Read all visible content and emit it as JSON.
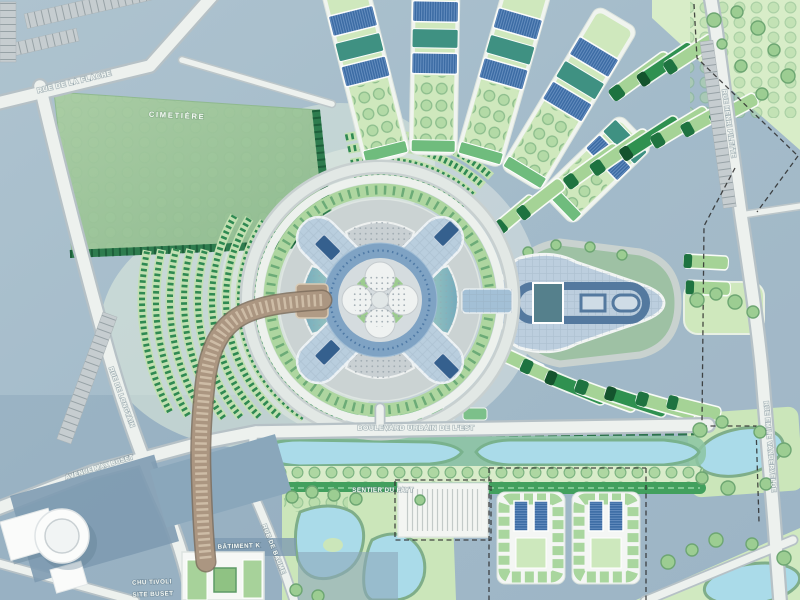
{
  "map": {
    "labels": {
      "cimetiere": "CIMETIÈRE",
      "rue_de_la_flache": "RUE DE LA FLACHE",
      "rue_de_longtain": "RUE DE LONGTAIN",
      "avenue_max_buset": "AVENUE MAX BUSET",
      "rue_henri_pilette": "RUE HENRI PILETTE",
      "rue_emile_vandervelde": "RUE EMILE VANDERVELDE",
      "boulevard_urbain": "BOULEVARD URBAIN DE L'EST",
      "sentier_du_fayt": "SENTIER DU FAYT",
      "rue_de_baume": "RUE DE BAUME",
      "batiment_k": "BÂTIMENT K",
      "chu_tivoli": "CHU TIVOLI",
      "site_buset": "SITE BUSET"
    },
    "palette": {
      "base_blue_grey": "#A6BFCD",
      "road_white": "#EDF1EE",
      "cemetery_green": "#9DC79C",
      "lawn_green": "#CFE8BD",
      "housing_strip_green": "#A5D396",
      "hedge_dark_green": "#1E7340",
      "teal_block": "#3F9182",
      "solar_roof_blue": "#3A6AA3",
      "plaza_building_blue": "#B9CEDE",
      "water_blue": "#AADBE9",
      "walkway_tan": "#AB9681",
      "existing_building_slate": "#7E9BB1",
      "boundary_dash_black": "#2B2B2B"
    }
  }
}
